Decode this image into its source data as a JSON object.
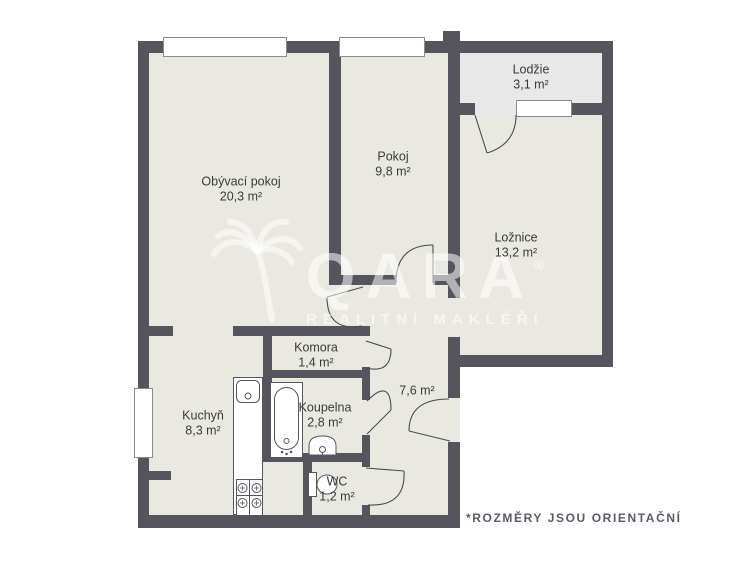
{
  "rooms": {
    "living": {
      "name": "Obývací pokoj",
      "area": "20,3 m²"
    },
    "pokoj": {
      "name": "Pokoj",
      "area": "9,8 m²"
    },
    "lodzie": {
      "name": "Lodžie",
      "area": "3,1 m²"
    },
    "loznice": {
      "name": "Ložnice",
      "area": "13,2 m²"
    },
    "komora": {
      "name": "Komora",
      "area": "1,4 m²"
    },
    "kuchyn": {
      "name": "Kuchyň",
      "area": "8,3 m²"
    },
    "koupelna": {
      "name": "Koupelna",
      "area": "2,8 m²"
    },
    "wc": {
      "name": "WC",
      "area": "1,2 m²"
    },
    "hall": {
      "area": "7,6 m²"
    }
  },
  "watermark": {
    "brand": "QARA",
    "registered": "®",
    "tagline": "REALITNÍ MAKLÉŘI"
  },
  "disclaimer": "*ROZMĚRY JSOU ORIENTAČNÍ",
  "colors": {
    "wall": "#55555d",
    "floor": "#eae9e1",
    "loggia": "#e8e8e8",
    "frame": "#8a8a92",
    "text": "#3a3a3a",
    "disc": "#5b5b67"
  }
}
